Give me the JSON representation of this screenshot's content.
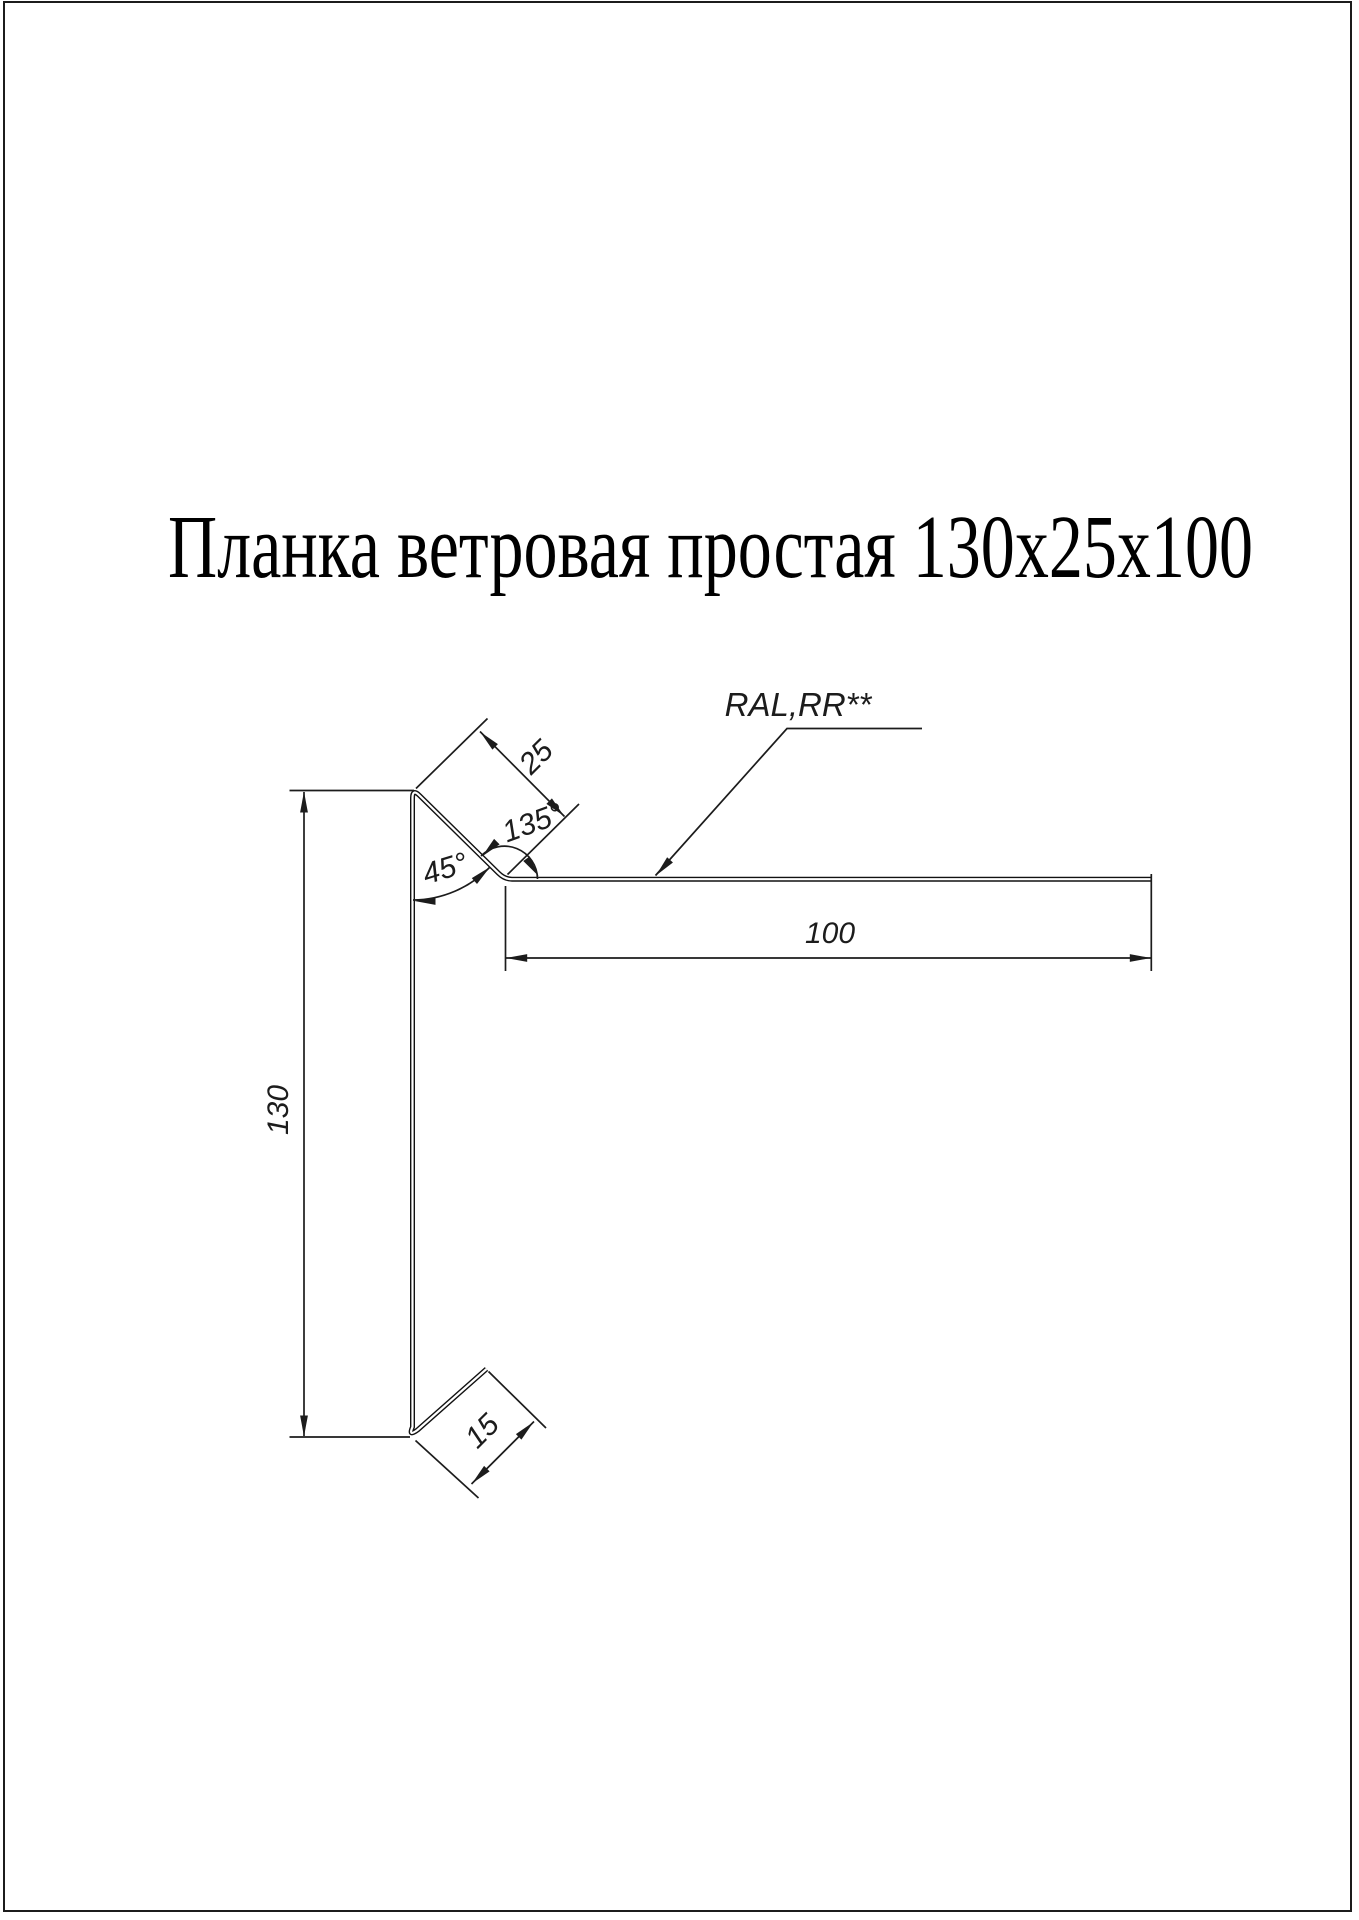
{
  "page": {
    "title": "Планка ветровая простая 130х25х100"
  },
  "annotations": {
    "coating_label": "RAL,RR**"
  },
  "dimensions": {
    "top_flange_length": "100",
    "height": "130",
    "upper_flange_width": "25",
    "upper_flange_angle": "135°",
    "bend_angle": "45°",
    "bottom_hem": "15"
  },
  "colors": {
    "line": "#1c1c1c",
    "background": "#ffffff"
  }
}
